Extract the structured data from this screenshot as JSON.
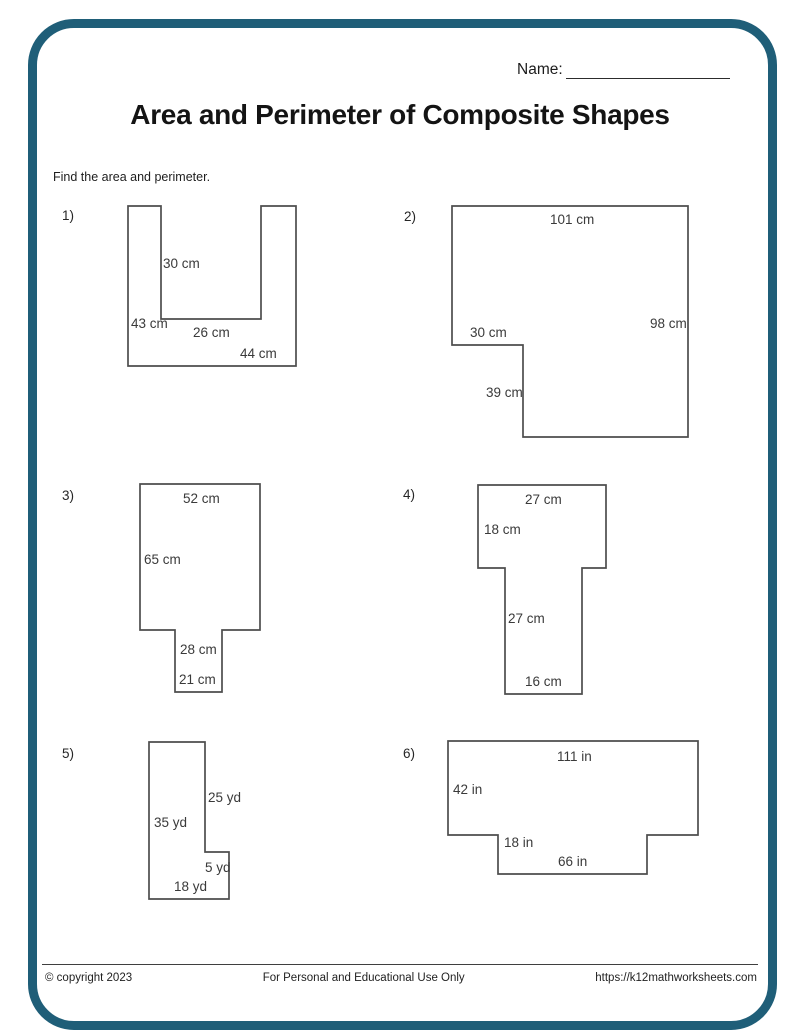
{
  "header": {
    "name_label": "Name:",
    "title": "Area and Perimeter of Composite Shapes",
    "instruction": "Find the area and perimeter."
  },
  "colors": {
    "page_border": "#1f5e78",
    "shape_outline": "#4d4d4d",
    "label_text": "#3a3a3a"
  },
  "problems": [
    {
      "id": "1",
      "number": "1)",
      "number_pos": {
        "x": 62,
        "y": 209
      },
      "points": "128,206 161,206 161,319 261,319 261,206 296,206 296,366 128,366",
      "labels": [
        {
          "text": "30 cm",
          "x": 163,
          "y": 257
        },
        {
          "text": "43 cm",
          "x": 131,
          "y": 317
        },
        {
          "text": "26 cm",
          "x": 193,
          "y": 326
        },
        {
          "text": "44 cm",
          "x": 240,
          "y": 347
        }
      ]
    },
    {
      "id": "2",
      "number": "2)",
      "number_pos": {
        "x": 404,
        "y": 210
      },
      "points": "452,206 688,206 688,437 523,437 523,345 452,345",
      "labels": [
        {
          "text": "101 cm",
          "x": 550,
          "y": 213
        },
        {
          "text": "98 cm",
          "x": 650,
          "y": 317
        },
        {
          "text": "30 cm",
          "x": 470,
          "y": 326
        },
        {
          "text": "39 cm",
          "x": 486,
          "y": 386
        }
      ]
    },
    {
      "id": "3",
      "number": "3)",
      "number_pos": {
        "x": 62,
        "y": 489
      },
      "points": "140,484 260,484 260,630 222,630 222,692 175,692 175,630 140,630",
      "labels": [
        {
          "text": "52 cm",
          "x": 183,
          "y": 492
        },
        {
          "text": "65 cm",
          "x": 144,
          "y": 553
        },
        {
          "text": "28 cm",
          "x": 180,
          "y": 643
        },
        {
          "text": "21 cm",
          "x": 179,
          "y": 673
        }
      ]
    },
    {
      "id": "4",
      "number": "4)",
      "number_pos": {
        "x": 403,
        "y": 488
      },
      "points": "478,485 606,485 606,568 582,568 582,694 505,694 505,568 478,568",
      "labels": [
        {
          "text": "27 cm",
          "x": 525,
          "y": 493
        },
        {
          "text": "18 cm",
          "x": 484,
          "y": 523
        },
        {
          "text": "27 cm",
          "x": 508,
          "y": 612
        },
        {
          "text": "16 cm",
          "x": 525,
          "y": 675
        }
      ]
    },
    {
      "id": "5",
      "number": "5)",
      "number_pos": {
        "x": 62,
        "y": 747
      },
      "points": "149,742 205,742 205,852 229,852 229,899 149,899",
      "labels": [
        {
          "text": "25 yd",
          "x": 208,
          "y": 791
        },
        {
          "text": "35 yd",
          "x": 154,
          "y": 816
        },
        {
          "text": "5 yd",
          "x": 205,
          "y": 861
        },
        {
          "text": "18 yd",
          "x": 174,
          "y": 880
        }
      ]
    },
    {
      "id": "6",
      "number": "6)",
      "number_pos": {
        "x": 403,
        "y": 747
      },
      "points": "448,741 698,741 698,835 647,835 647,874 498,874 498,835 448,835",
      "labels": [
        {
          "text": "111 in",
          "x": 557,
          "y": 750
        },
        {
          "text": "42 in",
          "x": 453,
          "y": 783
        },
        {
          "text": "18 in",
          "x": 504,
          "y": 836
        },
        {
          "text": "66 in",
          "x": 558,
          "y": 855
        }
      ]
    }
  ],
  "footer": {
    "copyright": "© copyright 2023",
    "usage": "For Personal and Educational Use Only",
    "url": "https://k12mathworksheets.com"
  }
}
